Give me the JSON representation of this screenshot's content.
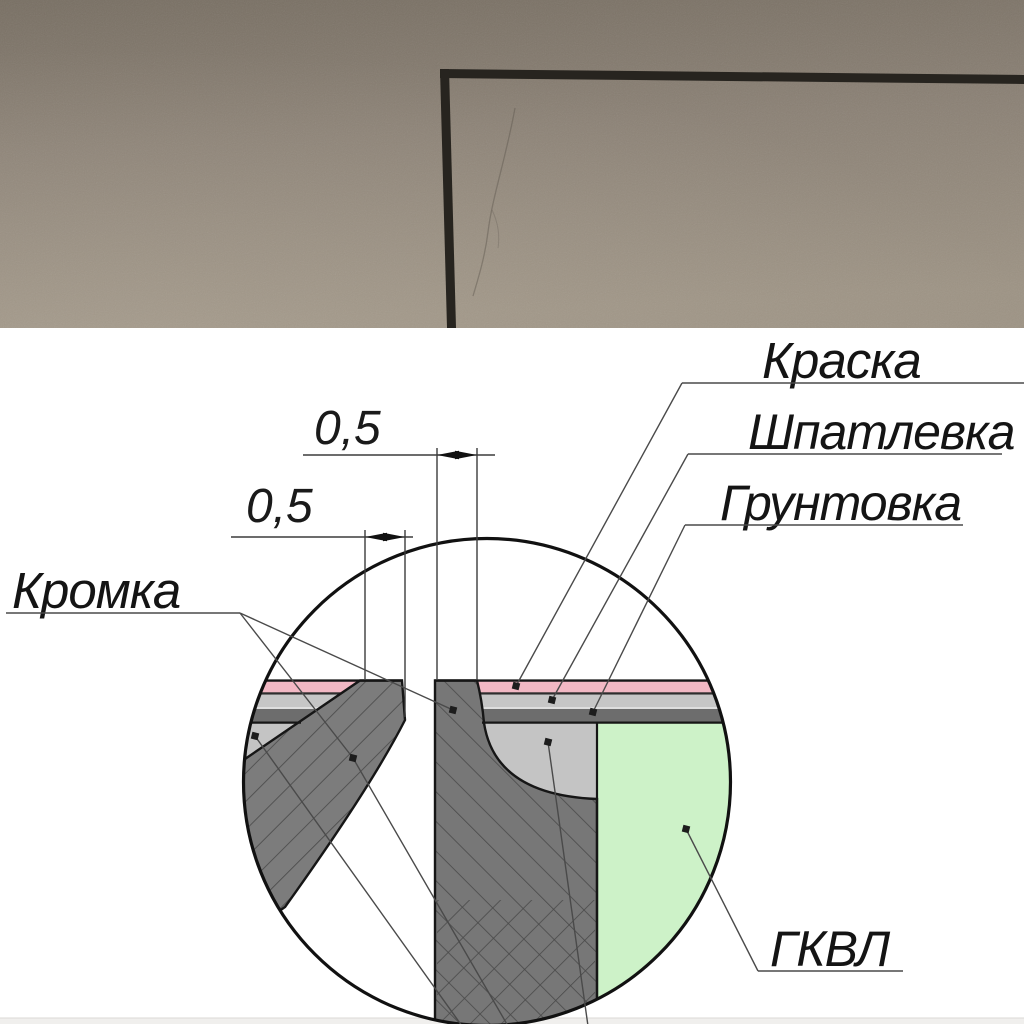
{
  "drawing": {
    "callouts": [
      {
        "id": "kraska",
        "label": "Краска"
      },
      {
        "id": "shpatlevka",
        "label": "Шпатлевка"
      },
      {
        "id": "gruntovka",
        "label": "Грунтовка"
      },
      {
        "id": "kromka",
        "label": "Кромка"
      },
      {
        "id": "gkvl",
        "label": "ГКВЛ"
      }
    ],
    "dimensions": [
      {
        "id": "dim-top",
        "value": "0,5"
      },
      {
        "id": "dim-bottom",
        "value": "0,5"
      }
    ],
    "colors": {
      "paint_pink": "#f2b8c4",
      "putty_gray": "#c6c6c6",
      "primer_dark": "#6d6d6d",
      "board_green": "#cdf2c8",
      "core_gray": "#7c7c7c",
      "core_gray2": "#777777",
      "bowl_gray": "#c4c4c4",
      "outline": "#161616"
    }
  }
}
